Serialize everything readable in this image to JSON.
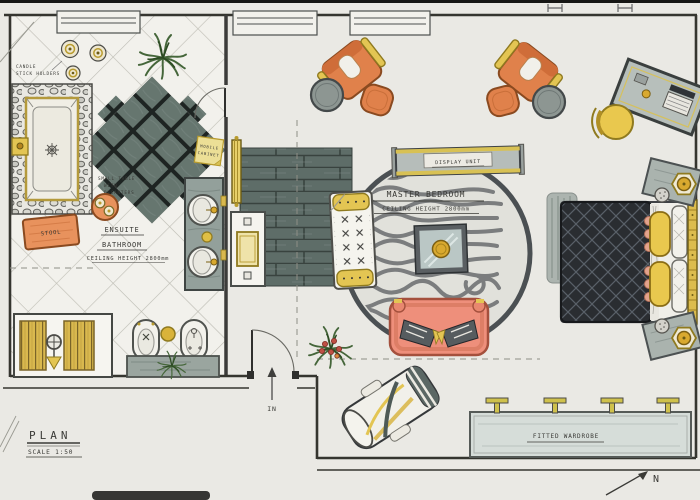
{
  "document": {
    "kind": "Hand-rendered interior design floor plan",
    "plan_title": "PLAN",
    "plan_scale": "SCALE 1:50",
    "entry_label": "IN",
    "north_label": "N"
  },
  "ensuite": {
    "name_line1": "ENSUITE",
    "name_line2": "BATHROOM",
    "ceiling_note": "CEILING HEIGHT 2800mm",
    "candle_note_line1": "CANDLE",
    "candle_note_line2": "STICK HOLDERS",
    "stool_label": "STOOL",
    "decanter_note_line1": "SMALL TABLE",
    "decanter_note_line2": "WITH",
    "decanter_note_line3": "DECANTERS",
    "cabinet_note_line1": "MOBILE",
    "cabinet_note_line2": "CABINET"
  },
  "bedroom": {
    "name": "MASTER BEDROOM",
    "ceiling_note": "CEILING HEIGHT 2800mm",
    "display_unit_label": "DISPLAY UNIT",
    "wardrobe_label": "FITTED WARDROBE"
  },
  "palette": {
    "paper": "#eae9e4",
    "ink": "#2f2f2d",
    "accent_orange": "#e0814b",
    "accent_gold": "#d9b84e",
    "accent_coral": "#ee8f7b",
    "slate_tile": "#64746f",
    "wood_floor": "#5e6d68",
    "quilt_charcoal": "#2a2d31"
  }
}
